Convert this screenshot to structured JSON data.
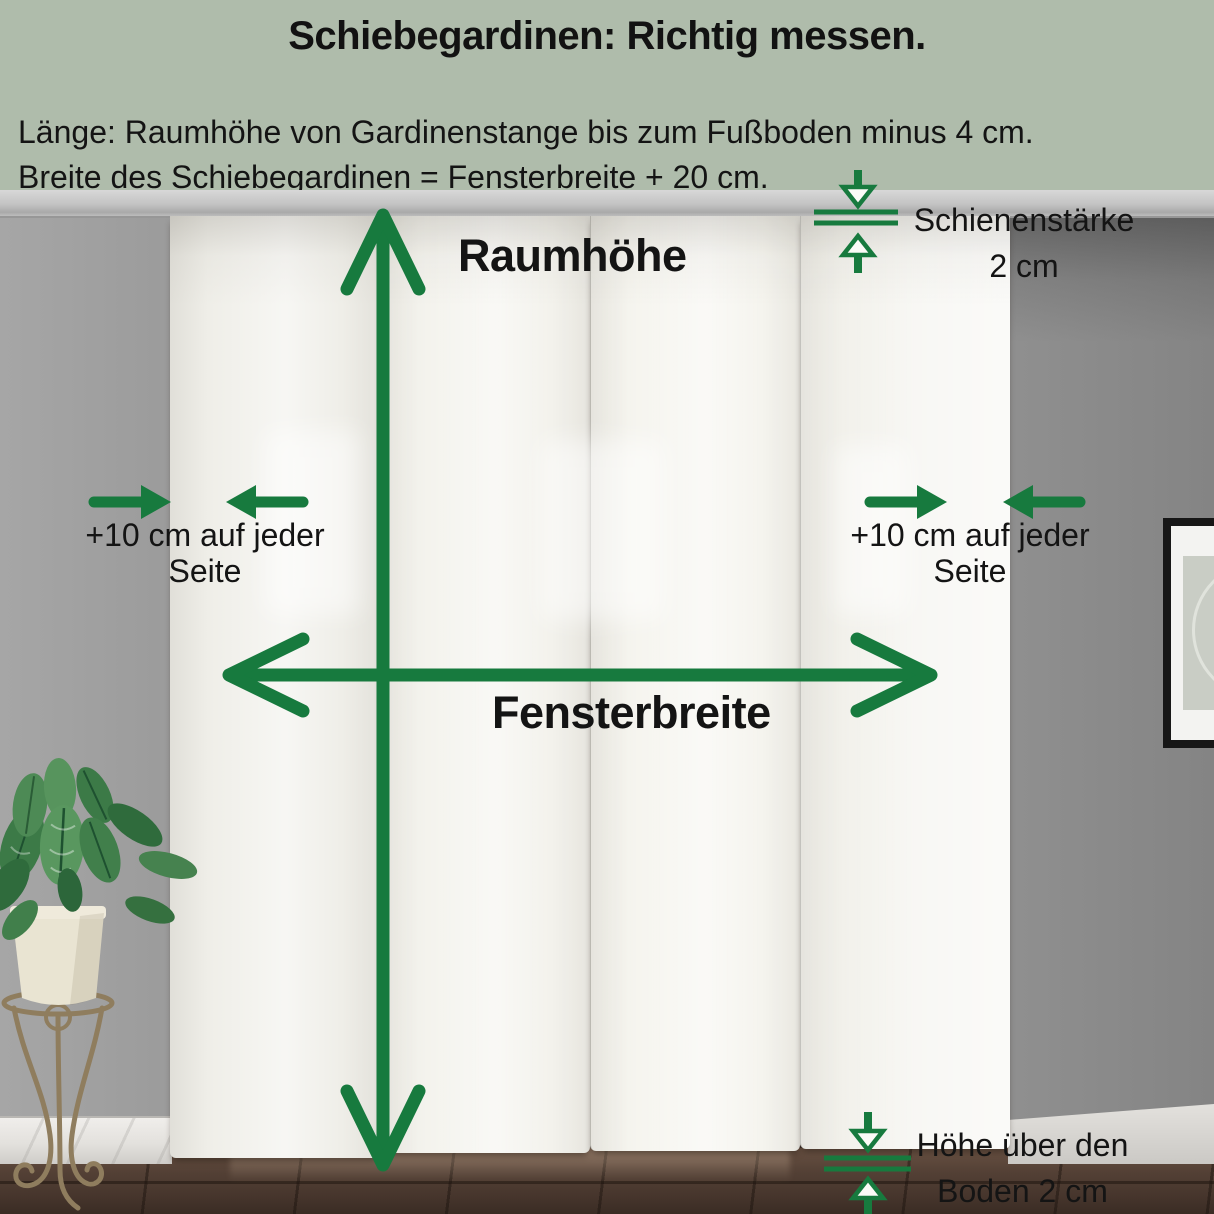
{
  "header": {
    "title": "Schiebegardinen: Richtig messen.",
    "line1": "Länge: Raumhöhe von Gardinenstange bis zum Fußboden minus 4 cm.",
    "line2": "Breite des Schiebegardinen = Fensterbreite + 20 cm."
  },
  "annotations": {
    "room_height_label": "Raumhöhe",
    "window_width_label": "Fensterbreite",
    "left_margin": {
      "line1": "+10 cm auf jeder",
      "line2": "Seite"
    },
    "right_margin": {
      "line1": "+10 cm auf jeder",
      "line2": "Seite"
    },
    "rail": {
      "line1": "Schienenstärke",
      "line2": "2 cm"
    },
    "floor": {
      "line1": "Höhe über den",
      "line2": "Boden 2 cm"
    }
  },
  "colors": {
    "accent_green": "#177a3e",
    "header_background": "#afbcab",
    "text": "#141414"
  }
}
